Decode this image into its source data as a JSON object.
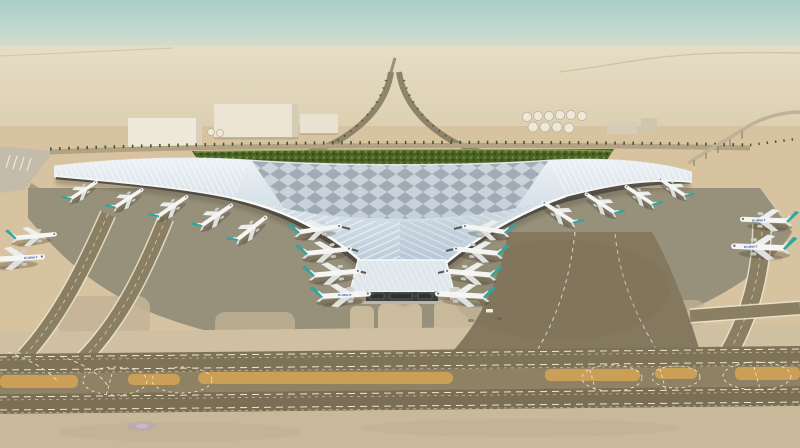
{
  "scene": {
    "subject": "aerial architectural rendering of a trident-shaped airport terminal in the desert",
    "aircraft_livery_title": "KUWAIT",
    "counts": {
      "aircraft_at_left_pier": 5,
      "aircraft_at_left_center_gates": 4,
      "aircraft_at_right_center_gates": 4,
      "aircraft_at_right_pier": 4,
      "aircraft_on_remote_stands": 4,
      "fuel_storage_tanks": 10,
      "cargo_warehouses": 3
    }
  },
  "palette": {
    "sky_top": "#a9cec7",
    "sky_mid": "#c6dacf",
    "horizon_haze": "#e3dcc8",
    "desert_far": "#dccfb0",
    "desert_mid": "#d8c3a0",
    "apron_light": "#cfc0a2",
    "apron_grey": "#97907a",
    "taxiway_dark": "#7e7257",
    "taxiway_median": "#8f8164",
    "marking_white": "#ece5d0",
    "marking_yellow": "#d2a253",
    "roof_light": "#ecf1f4",
    "roof_blue": "#c9d7e2",
    "roof_shade": "#aebfcf",
    "diamond_dark": "#8b97a3",
    "facade_dark": "#4b4740",
    "green_canopy": "#4a6226",
    "green_light": "#6e8d3f",
    "palm_green": "#3e5a2c",
    "tail_teal": "#31a69e",
    "fuselage_white": "#f5f6f4",
    "livery_blue": "#1d4ea0",
    "building_white": "#eee8d8",
    "road_tan": "#b2a283",
    "runway_grey": "#c3bcab"
  }
}
